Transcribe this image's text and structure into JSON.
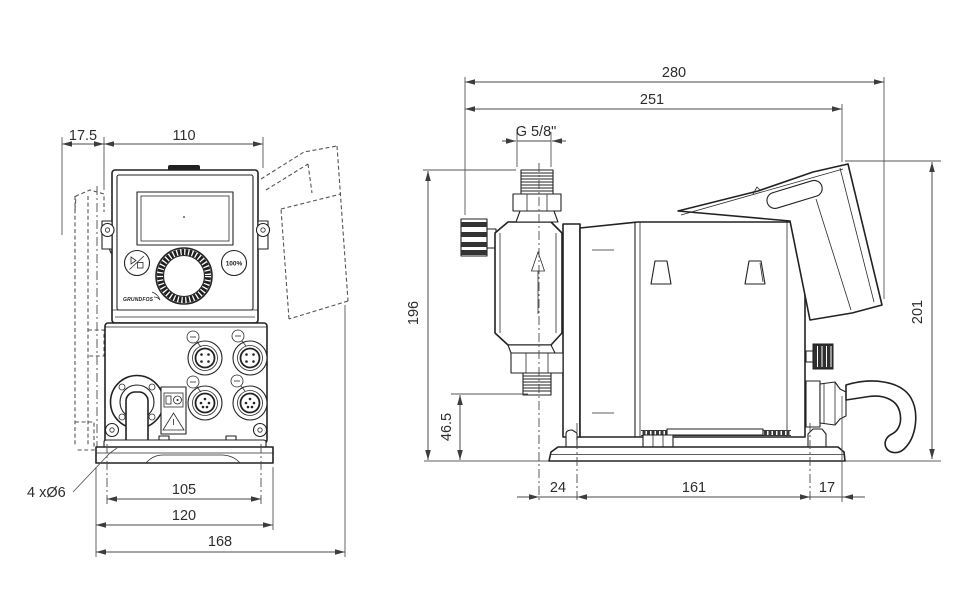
{
  "front_view": {
    "dimensions": {
      "bracket_depth": "17.5",
      "housing_width": "110",
      "mounting_hole_spacing": "105",
      "base_width": "120",
      "overall_depth_with_panel": "168"
    },
    "mounting_holes_note": "4 xØ6",
    "control_panel": {
      "capacity_button": "100%",
      "brand": "GRUNDFOS"
    }
  },
  "side_view": {
    "dimensions": {
      "overall_length": "280",
      "length_to_panel": "251",
      "connection_thread": "G 5/8\"",
      "height_to_connection_top": "196",
      "overall_height": "201",
      "suction_valve_height": "46.5",
      "valve_center_to_front_hole": "24",
      "base_hole_spacing": "161",
      "rear_hole_to_gland_face": "17"
    }
  }
}
